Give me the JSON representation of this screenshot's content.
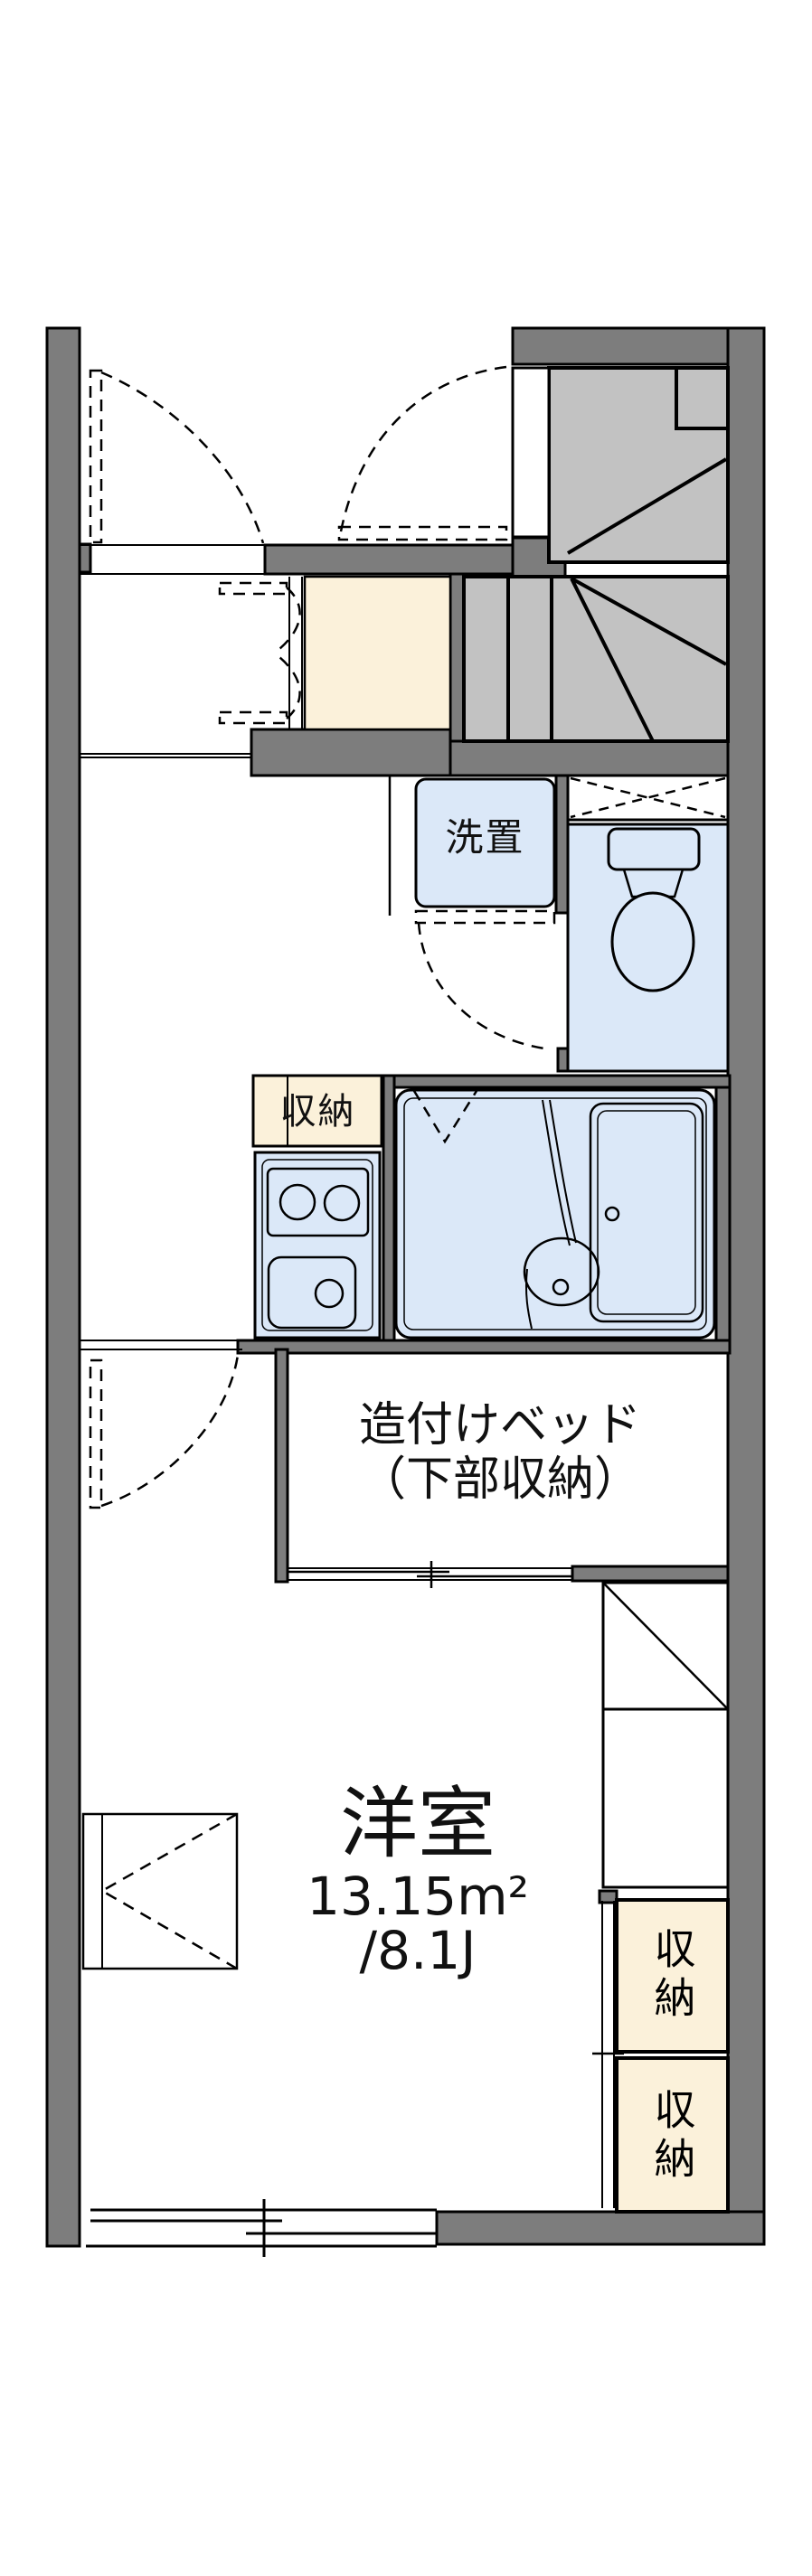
{
  "floorplan": {
    "type": "japanese-apartment-floor-plan",
    "rooms": {
      "washer_alcove": {
        "label": "洗置"
      },
      "kitchen_storage": {
        "label": "収納"
      },
      "built_in_bed": {
        "line1": "造付けベッド",
        "line2": "（下部収納）"
      },
      "western_room": {
        "name": "洋室",
        "area_sqm": "13.15m²",
        "area_jo": "/8.1J"
      },
      "closet_upper": {
        "label": "収納"
      },
      "closet_lower": {
        "label": "収納"
      }
    },
    "colors": {
      "wall": "#7d7d7d",
      "stairs": "#c2c2c2",
      "fixture_blue": "#dbe8f8",
      "storage_cream": "#fbf1da",
      "line": "#000000",
      "text": "#111111",
      "background": "#ffffff"
    }
  }
}
